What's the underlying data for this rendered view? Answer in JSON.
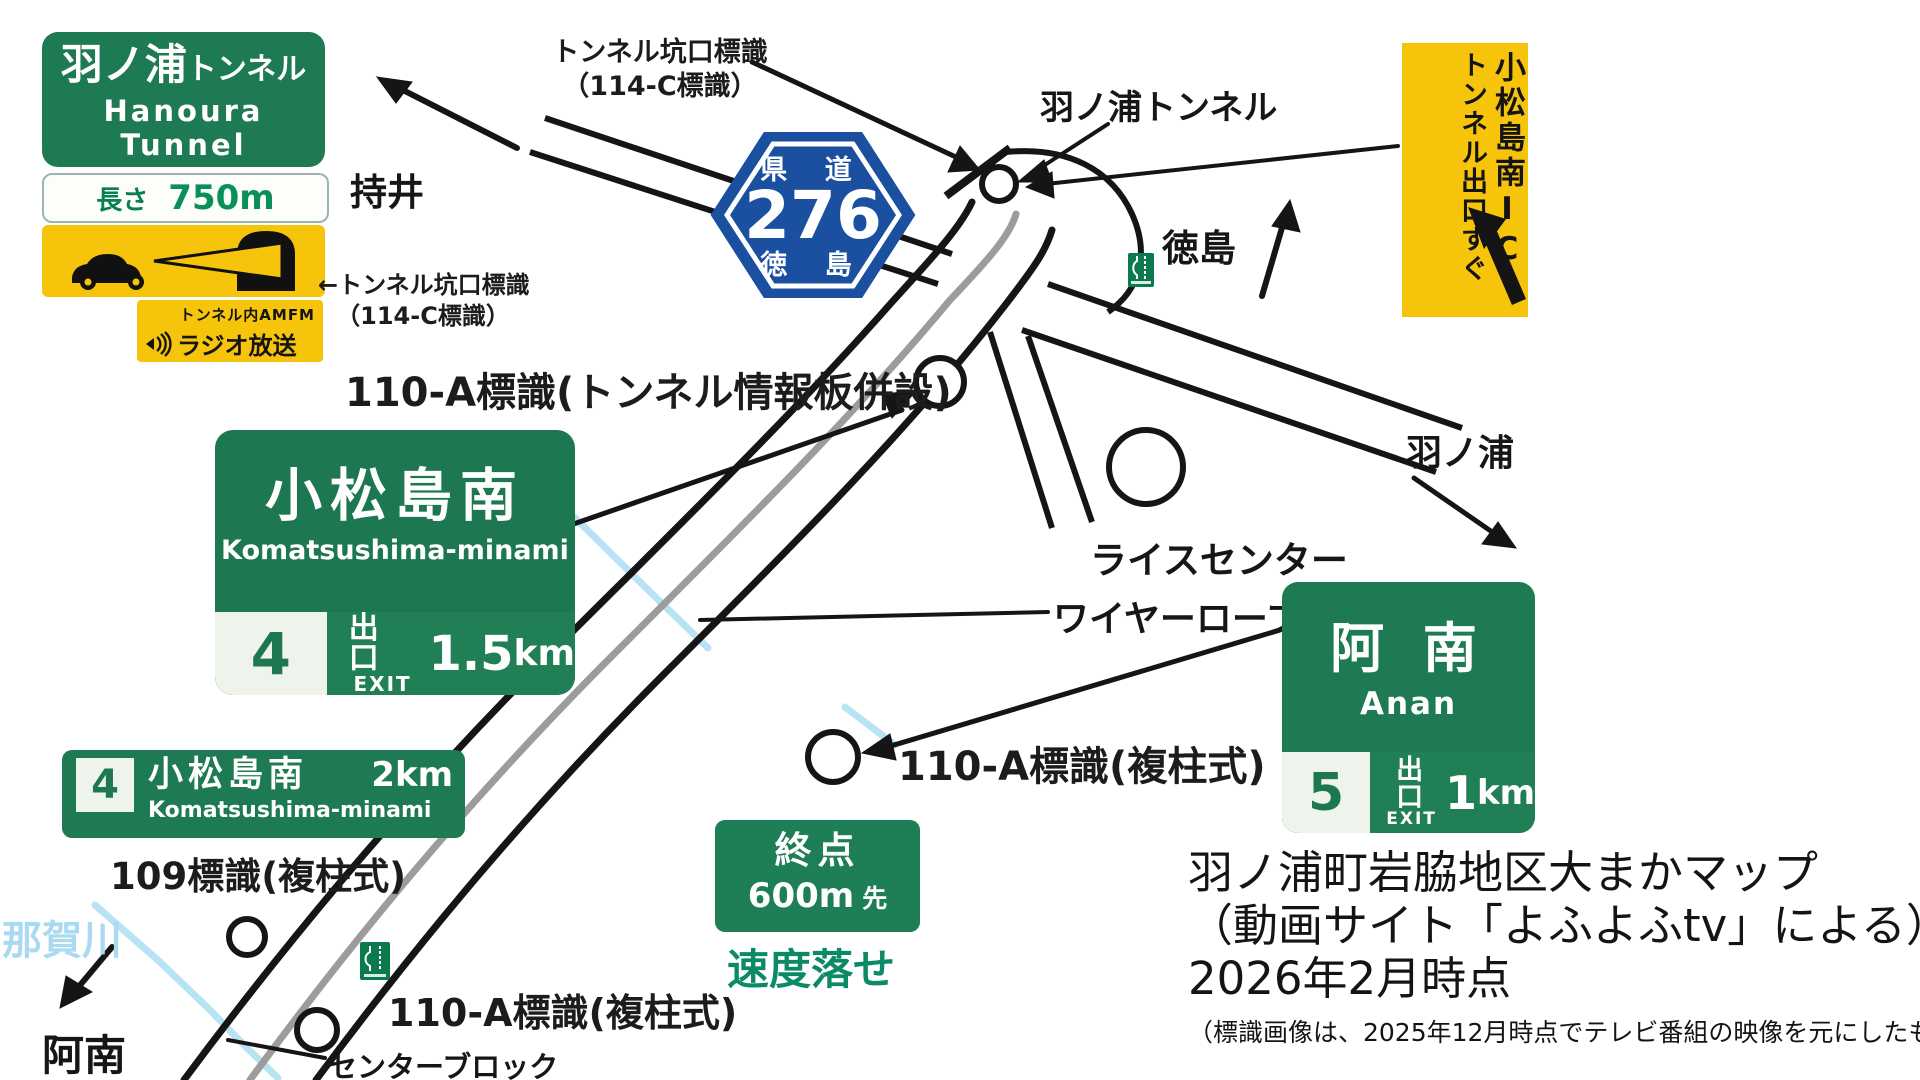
{
  "colors": {
    "sign_green": "#1e7a52",
    "sign_yellow": "#f6c50b",
    "route_blue": "#1b4fa0",
    "river_blue": "#b7e3f4",
    "speed_teal": "#0c8a68",
    "road_black": "#151515",
    "road_center_gray": "#9c9c9c"
  },
  "signs": {
    "hanoura_tunnel_guide": {
      "title_jp": "羽ノ浦",
      "title_suffix": "トンネル",
      "title_en": "Hanoura Tunnel"
    },
    "tunnel_length": {
      "label": "長さ",
      "value": "750m"
    },
    "radio": {
      "line1": "トンネル内AMFM",
      "line2": "ラジオ放送"
    },
    "route_276": {
      "road_type": "県 道",
      "number": "276",
      "prefecture": "徳 島"
    },
    "ic_exit": {
      "column_right": "小松島南IC",
      "column_left": "トンネル出口すぐ"
    },
    "komatsushima_big": {
      "name_jp": "小松島南",
      "name_en": "Komatsushima-minami",
      "exit_number": "4",
      "exit_jp": "出口",
      "exit_en": "EXIT",
      "distance_value": "1.5",
      "distance_unit": "km"
    },
    "komatsushima_small": {
      "exit_number": "4",
      "name_jp": "小松島南",
      "distance": "2km",
      "name_en": "Komatsushima-minami"
    },
    "anan": {
      "name_jp": "阿 南",
      "name_en": "Anan",
      "exit_number": "5",
      "exit_jp": "出口",
      "exit_en": "EXIT",
      "distance_value": "1",
      "distance_unit": "km"
    },
    "terminus": {
      "line1": "終点",
      "value": "600m",
      "suffix": "先"
    },
    "speed_warning": "速度落せ"
  },
  "place_labels": {
    "mochii": "持井",
    "tokushima": "徳島",
    "hanoura": "羽ノ浦",
    "hanoura_tunnel": "羽ノ浦トンネル",
    "rice_center": "ライスセンター",
    "wire_rope": "ワイヤーロープ",
    "nakagawa_river": "那賀川",
    "anan": "阿南",
    "center_block": "センターブロック"
  },
  "annotations": {
    "portal_sign_top_1": "トンネル坑口標識",
    "portal_sign_top_2": "（114-C標識）",
    "portal_sign_left_1": "←トンネル坑口標識",
    "portal_sign_left_2": "（114-C標識）",
    "info_board": "110-A標識(トンネル情報板併設)",
    "double_pillar_mid": "110-A標識(複柱式)",
    "double_pillar_bottom": "110-A標識(複柱式)",
    "sign_109": "109標識(複柱式)"
  },
  "credit": {
    "line1": "羽ノ浦町岩脇地区大まかマップ",
    "line2": "（動画サイト「よふよふtv」による）",
    "line3": "2026年2月時点",
    "line4": "（標識画像は、2025年12月時点でテレビ番組の映像を元にしたものです）"
  }
}
